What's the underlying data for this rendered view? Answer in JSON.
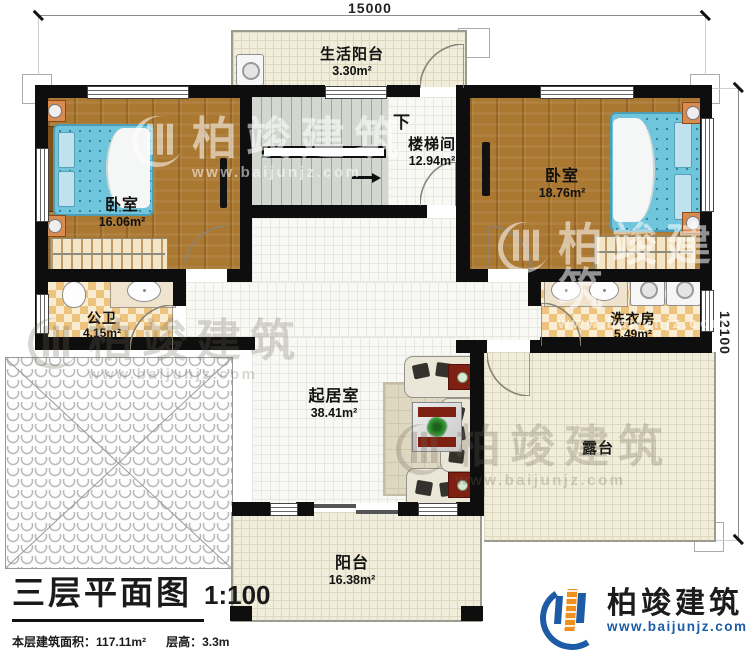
{
  "plan": {
    "dimensions": {
      "width_label": "15000",
      "height_label": "12100"
    },
    "rooms": {
      "life_balcony": {
        "name": "生活阳台",
        "area": "3.30m²"
      },
      "stairwell": {
        "name": "楼梯间",
        "area": "12.94m²"
      },
      "bedroom_left": {
        "name": "卧室",
        "area": "16.06m²"
      },
      "bedroom_right": {
        "name": "卧室",
        "area": "18.76m²"
      },
      "public_bath": {
        "name": "公卫",
        "area": "4.15m²"
      },
      "laundry": {
        "name": "洗衣房",
        "area": "5.49m²"
      },
      "living_room": {
        "name": "起居室",
        "area": "38.41m²"
      },
      "terrace": {
        "name": "露台"
      },
      "balcony": {
        "name": "阳台",
        "area": "16.38m²"
      }
    },
    "stairs": {
      "direction_label": "下"
    }
  },
  "title_block": {
    "title": "三层平面图",
    "scale": "1:100",
    "area_label": "本层建筑面积：",
    "area_value": "117.11m²",
    "height_label": "层高：",
    "height_value": "3.3m"
  },
  "logo": {
    "company": "柏竣建筑",
    "website": "www.baijunjz.com"
  },
  "watermark": {
    "company": "柏竣建筑",
    "website": "www.baijunjz.com"
  },
  "colors": {
    "wall": "#0e0e0e",
    "wood_floor": "#ab7832",
    "bed_blue": "#6fc5dc",
    "tile_beige": "#f0edda",
    "tile_checker": "#eec37e",
    "brand_blue": "#1d5ca5",
    "brand_orange": "#f0911f"
  }
}
